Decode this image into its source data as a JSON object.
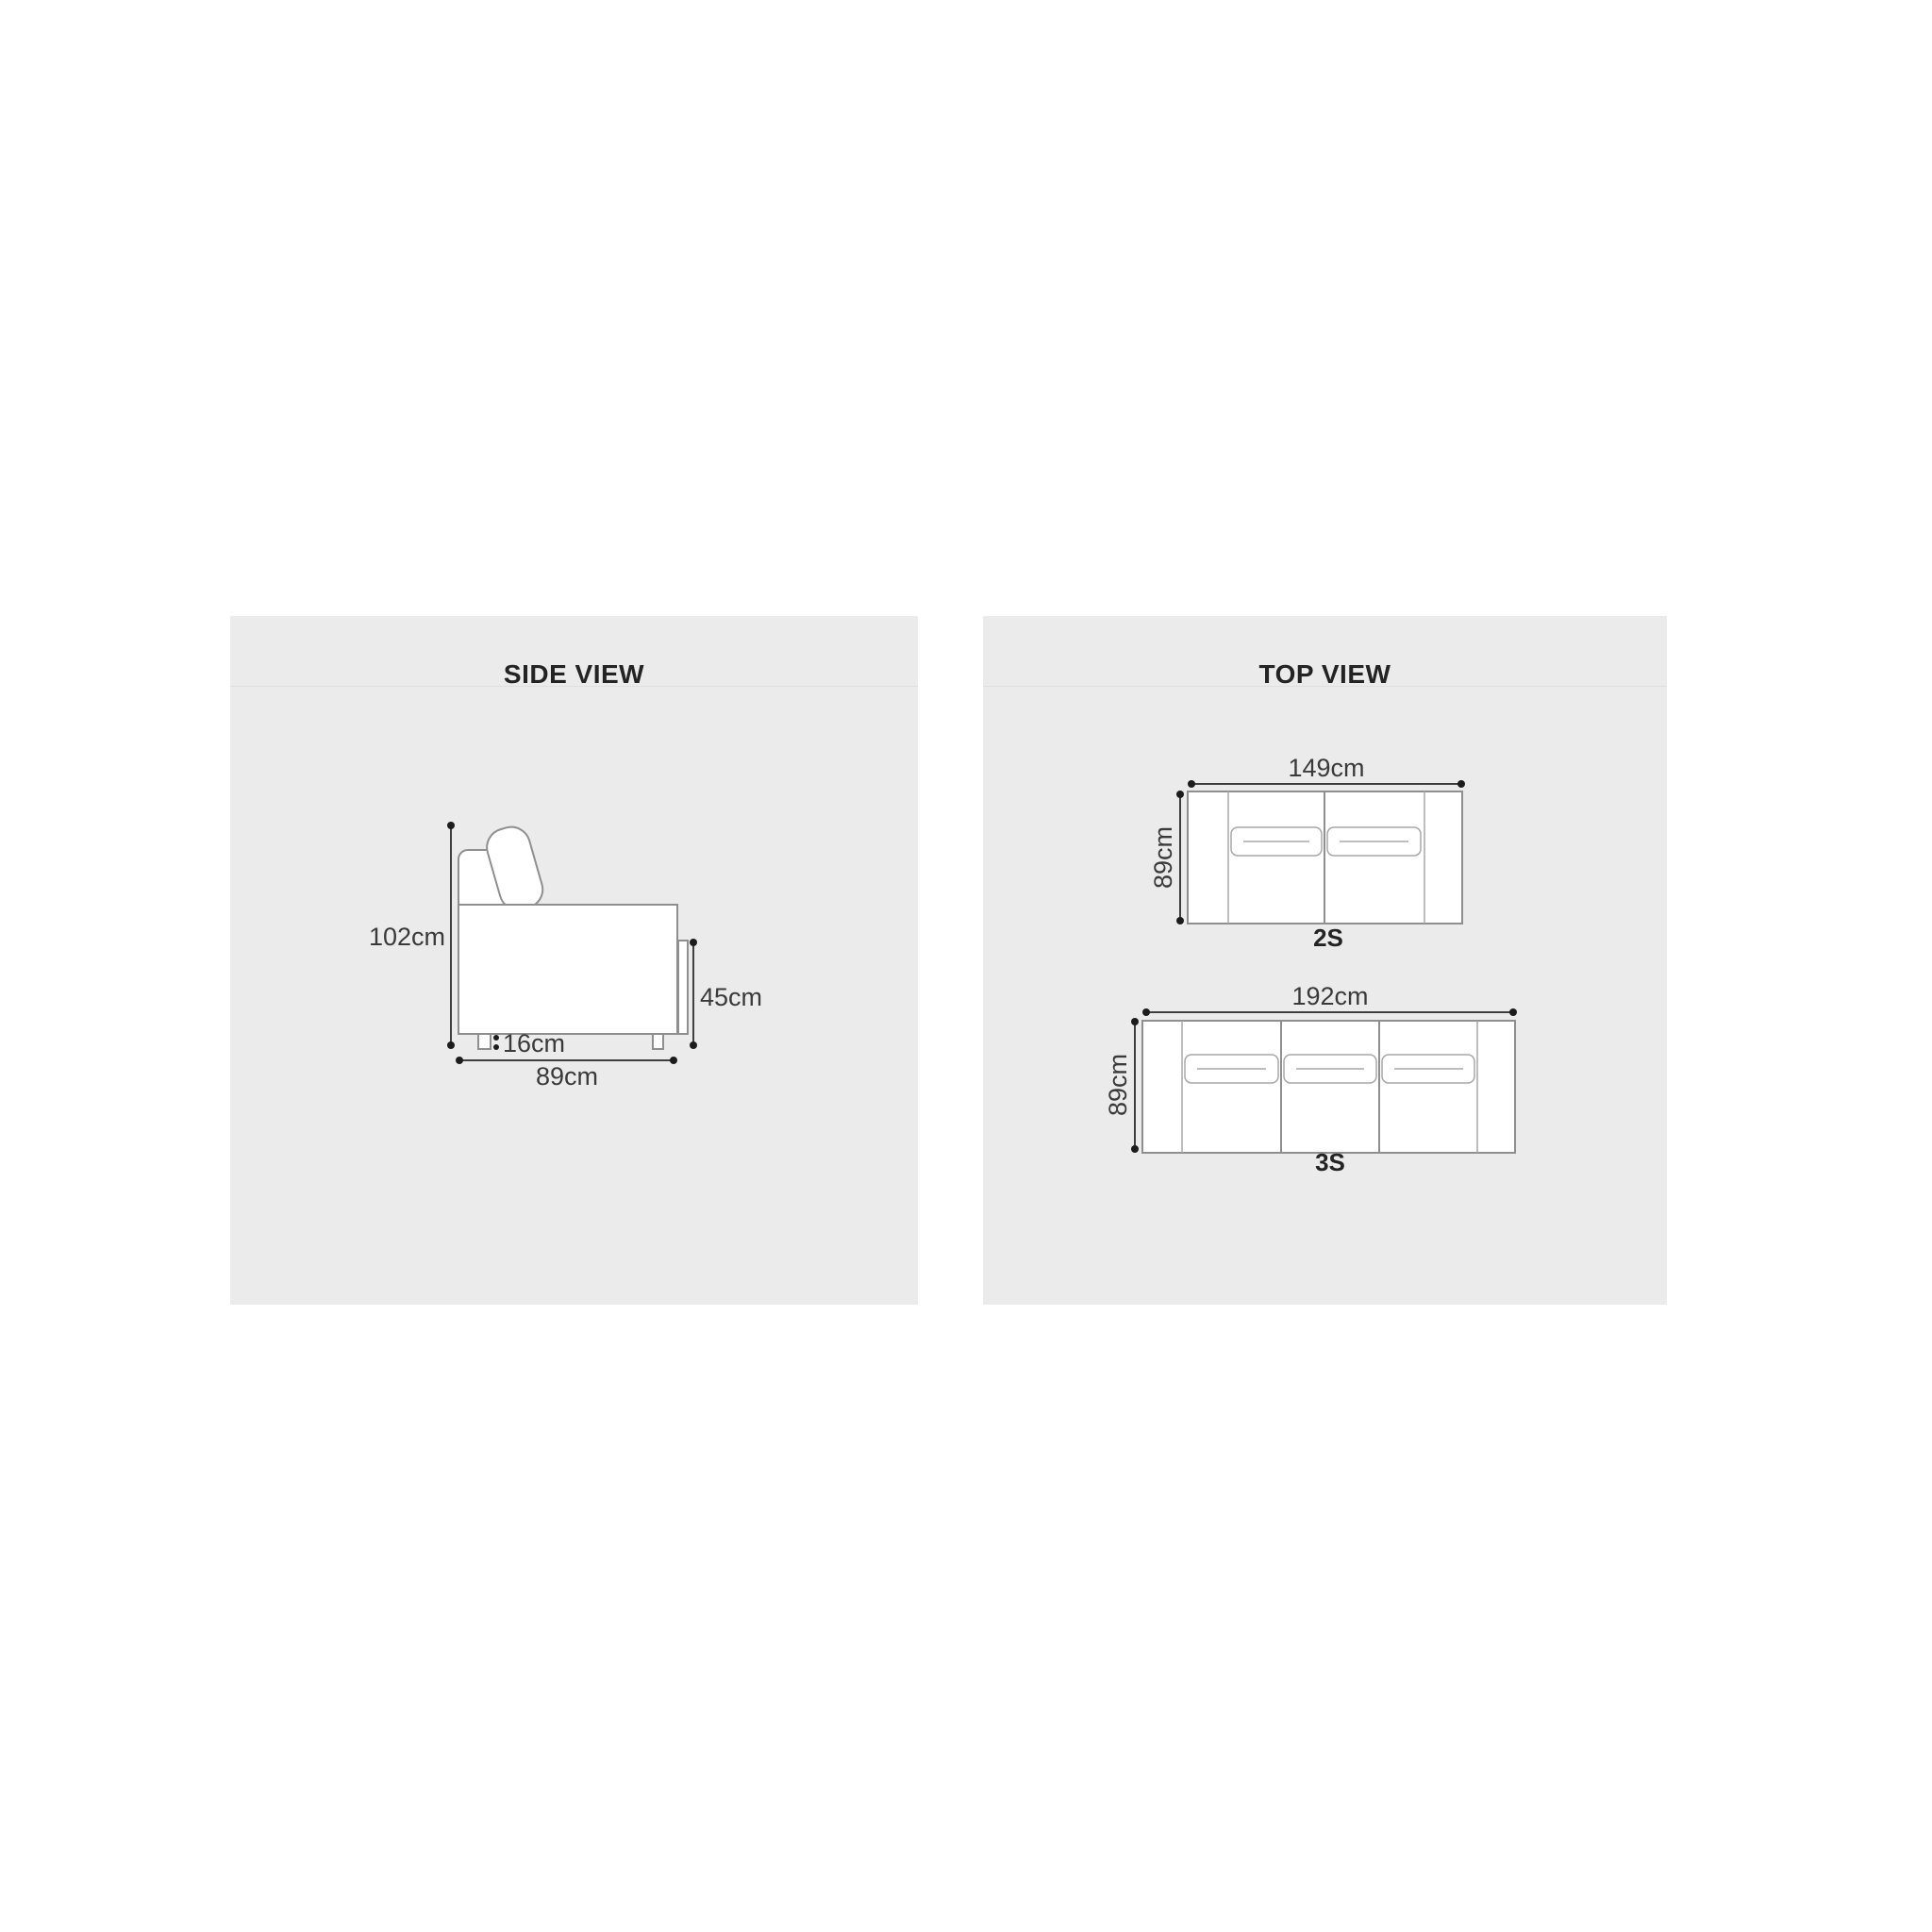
{
  "side_view": {
    "title": "SIDE VIEW",
    "labels": {
      "height": "102cm",
      "seat_height": "45cm",
      "leg_height": "16cm",
      "depth": "89cm"
    }
  },
  "top_view": {
    "title": "TOP VIEW",
    "two_seater": {
      "label": "2S",
      "width": "149cm",
      "depth": "89cm"
    },
    "three_seater": {
      "label": "3S",
      "width": "192cm",
      "depth": "89cm"
    }
  },
  "colors": {
    "page_background": "#ffffff",
    "panel_background": "#ecebeb",
    "sofa_outline": "#8f8f8f",
    "cushion_outline": "#a8a8a8",
    "dimension_line": "#3f3f3f",
    "text": "#232323"
  }
}
